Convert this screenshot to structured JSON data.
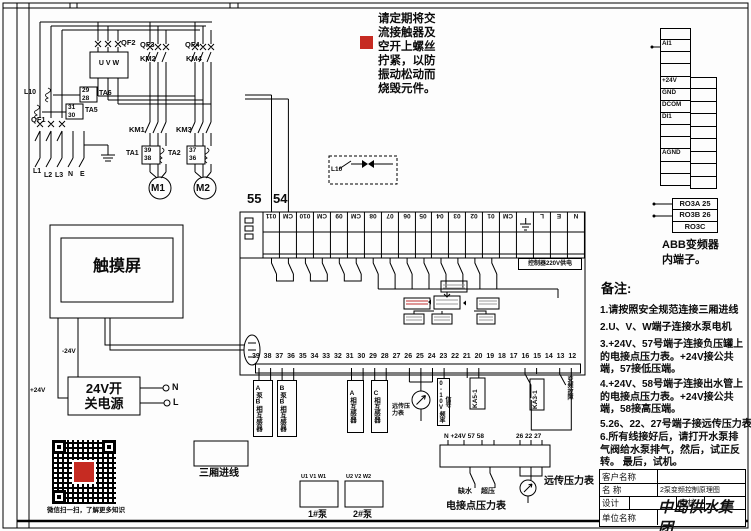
{
  "note_top": {
    "text": "请定期将交\n流接触器及\n空开上螺丝\n拧紧，以防\n振动松动而\n烧毁元件。"
  },
  "power": {
    "qf1": "QF1",
    "qf2": "QF2",
    "qf3": "QF3",
    "qf4": "QF4",
    "km1": "KM1",
    "km2": "KM2",
    "km3": "KM3",
    "km4": "KM4",
    "ta1": "TA1",
    "ta2": "TA2",
    "ta5": "TA5",
    "ta6": "TA6",
    "uvw": "U V W",
    "l10": "L10",
    "t29": "29",
    "t28": "28",
    "t31": "31",
    "t30": "30",
    "t39": "39",
    "t38": "38",
    "t37": "37",
    "t36": "36",
    "l1": "L1",
    "l2": "L2",
    "l3": "L3",
    "n": "N",
    "e": "E",
    "m1": "M1",
    "m2": "M2"
  },
  "float_switch": {
    "l10": "L10"
  },
  "plc": {
    "t55": "55",
    "t54": "54",
    "top_terminals": [
      "011",
      "CM",
      "010",
      "CM",
      "09",
      "CM",
      "08",
      "07",
      "06",
      "05",
      "04",
      "03",
      "02",
      "01",
      "CM",
      "",
      "L",
      "E",
      "N"
    ],
    "supply_label": "控制器220V供电",
    "bottom_terminals": [
      "39",
      "38",
      "37",
      "36",
      "35",
      "34",
      "33",
      "32",
      "31",
      "30",
      "29",
      "28",
      "27",
      "26",
      "25",
      "24",
      "23",
      "22",
      "21",
      "20",
      "19",
      "18",
      "17",
      "16",
      "15",
      "14",
      "13",
      "12"
    ]
  },
  "touchscreen": {
    "label": "触摸屏",
    "minus24": "-24V",
    "plus24": "+24V"
  },
  "psu": {
    "label": "24V开\n关电源",
    "n": "N",
    "l": "L"
  },
  "abb": {
    "left_cells": [
      "",
      "AI1",
      "",
      "",
      "+24V",
      "GND",
      "DCOM",
      "DI1",
      "",
      "",
      "AGND",
      "",
      ""
    ],
    "right_cells": [
      "",
      "",
      "",
      "",
      "",
      "",
      "",
      "",
      ""
    ],
    "relay_rows": [
      "RO3A 25",
      "RO3B 26",
      "RO3C"
    ],
    "caption": "ABB变频器\n内端子。"
  },
  "sensors": {
    "ct_a_pump": "A泵B相互感器",
    "ct_b_pump": "B泵B相互感器",
    "ct_a_phase": "A相互感器",
    "ct_c_phase": "C相互感器",
    "remote_gauge_small": "远传压\n力表",
    "signal": "0-10V频率信号",
    "ka5": "KA5-1",
    "ka3": "KA3-1",
    "vfd_fault": "变频故障"
  },
  "bottom": {
    "qr_caption": "微信扫一扫，了解更多知识",
    "three_phase_label": "三厢进线",
    "pump1_terms": "U1 V1 W1",
    "pump2_terms": "U2 V2 W2",
    "pump1": "1#泵",
    "pump2": "2#泵",
    "strip_labels_left": "N   +24V 57 58",
    "strip_labels_right": "26 22 27",
    "low_water": "缺水",
    "over_pressure": "超压",
    "contact_gauge": "电接点压力表",
    "remote_gauge": "远传压力表"
  },
  "notes": {
    "title": "备注:",
    "n1": "1.请按照安全规范连接三厢进线",
    "n2": "2.U、V、W端子连接水泵电机",
    "n3": "3.+24V、57号端子连接负压罐上的电接点压力表。+24V接公共端，57接低压端。",
    "n4": "4.+24V、58号端子连接出水管上的电接点压力表。+24V接公共端，58接高压端。",
    "n5": "5.26、22、27号端子接远传压力表",
    "n6": "6.所有线接好后，请打开水泵排气阀给水泵排气，然后，试正反转。 最后，试机。"
  },
  "titleblock": {
    "customer": "客户名称",
    "name_label": "名  称",
    "name_value": "2泵变频控制原理图",
    "design": "设计",
    "review": "审核",
    "company_label": "单位名称",
    "company": "中岛供水集团"
  },
  "colors": {
    "accent_red": "#c62b22",
    "line": "#000000"
  }
}
